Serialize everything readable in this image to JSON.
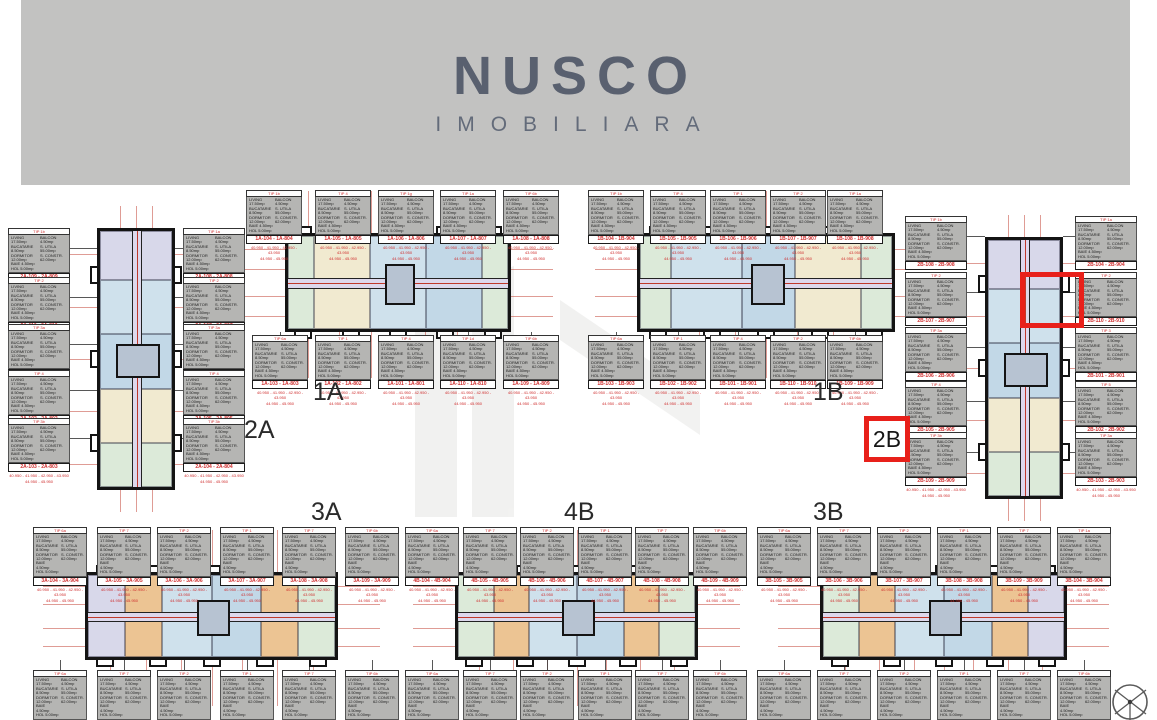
{
  "logo": {
    "title": "NUSCO",
    "subtitle": "IMOBILIARA"
  },
  "palette": {
    "banner": "#c2c2c1",
    "logo": "#59606f",
    "dim_red": "#c0392b",
    "card_red": "#cf2e2e",
    "highlight_red": "#e8201a",
    "plan_border": "#141414",
    "card_gray": "#b5b5b3",
    "corridor": "#ddd8ec",
    "watermark": "#ececec",
    "unit_green": "#dcead9",
    "unit_cream": "#f1ead0",
    "unit_blue": "#cfe1ec",
    "unit_blue2": "#c2d8e7",
    "unit_lavender": "#d8d8ea",
    "unit_orange": "#ecc493"
  },
  "card_shared": {
    "details_left": [
      "LIVING 17.50mp",
      "BUCATARIE 8.50mp",
      "DORMITOR 12.00mp",
      "BAIE 4.50mp",
      "HOL 5.00mp"
    ],
    "details_right": [
      "BALCON 4.50mp",
      "S. UTILA 55.00mp",
      "S. CONSTR. 62.00mp"
    ],
    "prices_line1": "40.950 - 41.950 - 42.950 - 43.950",
    "prices_line2": "44.950 - 45.950"
  },
  "buildings": [
    {
      "id": "2A",
      "title": "2A",
      "orientation": "vertical",
      "plan": {
        "x": 97,
        "y": 228,
        "w": 78,
        "h": 262
      },
      "title_pos": {
        "x": 244,
        "y": 416
      },
      "sections": [
        {
          "color": "#d8d8ea",
          "flex": 1
        },
        {
          "color": "#cfe1ec",
          "flex": 1.1
        },
        {
          "color": "#c2d8e7",
          "flex": 1.1
        },
        {
          "color": "#f1ead0",
          "flex": 1.1
        },
        {
          "color": "#dcead9",
          "flex": 0.9
        }
      ],
      "cards": {
        "left": {
          "x": 8,
          "w": 62,
          "tops": [
            228,
            277,
            324,
            370,
            418
          ],
          "items": [
            {
              "tip": "TIP 1b",
              "unit": "2A-109 - 2A-809"
            },
            {
              "tip": "TIP 2",
              "unit": "2A-110 - 2A-810"
            },
            {
              "tip": "TIP 3a",
              "unit": "2A-101 - 2A-801"
            },
            {
              "tip": "TIP 4",
              "unit": "2A-102 - 2A-802"
            },
            {
              "tip": "TIP 3b",
              "unit": "2A-103 - 2A-803"
            }
          ]
        },
        "right": {
          "x": 183,
          "w": 62,
          "tops": [
            228,
            277,
            324,
            370,
            418
          ],
          "items": [
            {
              "tip": "TIP 1a",
              "unit": "2A-108 - 2A-808"
            },
            {
              "tip": "TIP 2",
              "unit": "2A-107 - 2A-807"
            },
            {
              "tip": "TIP 3a",
              "unit": "2A-106 - 2A-806"
            },
            {
              "tip": "TIP 4",
              "unit": "2A-105 - 2A-805"
            },
            {
              "tip": "TIP 3b",
              "unit": "2A-104 - 2A-804"
            }
          ]
        }
      }
    },
    {
      "id": "1A",
      "title": "1A",
      "orientation": "horizontal",
      "plan": {
        "x": 285,
        "y": 233,
        "w": 226,
        "h": 99
      },
      "title_pos": {
        "x": 313,
        "y": 378
      },
      "sections": [
        {
          "color": "#dcead9",
          "flex": 0.7
        },
        {
          "color": "#f1ead0",
          "flex": 1.5
        },
        {
          "color": "#cfe1ec",
          "flex": 1.5
        },
        {
          "color": "#c2d8e7",
          "flex": 1.5
        },
        {
          "color": "#dcead9",
          "flex": 0.7
        }
      ],
      "cards": {
        "top": {
          "y": 190,
          "w": 56,
          "xs": [
            246,
            315,
            378,
            440,
            503
          ],
          "items": [
            {
              "tip": "TIP 1b",
              "unit": "1A-104 - 1A-804"
            },
            {
              "tip": "TIP 4",
              "unit": "1A-105 - 1A-805"
            },
            {
              "tip": "TIP 1g",
              "unit": "1A-106 - 1A-806"
            },
            {
              "tip": "TIP 1a",
              "unit": "1A-107 - 1A-807"
            },
            {
              "tip": "TIP 6b",
              "unit": "1A-108 - 1A-808"
            }
          ]
        },
        "bottom": {
          "y": 335,
          "w": 56,
          "xs": [
            252,
            315,
            378,
            440,
            503
          ],
          "items": [
            {
              "tip": "TIP 6a",
              "unit": "1A-103 - 1A-803"
            },
            {
              "tip": "TIP 1",
              "unit": "1A-102 - 1A-802"
            },
            {
              "tip": "TIP 4",
              "unit": "1A-101 - 1A-801"
            },
            {
              "tip": "TIP 1d",
              "unit": "1A-110 - 1A-810"
            },
            {
              "tip": "TIP 6b",
              "unit": "1A-109 - 1A-809"
            }
          ]
        }
      }
    },
    {
      "id": "1B",
      "title": "1B",
      "orientation": "horizontal",
      "plan": {
        "x": 637,
        "y": 233,
        "w": 258,
        "h": 99
      },
      "title_pos": {
        "x": 813,
        "y": 378
      },
      "sections": [
        {
          "color": "#dcead9",
          "flex": 0.7
        },
        {
          "color": "#cfe1ec",
          "flex": 1.6
        },
        {
          "color": "#c2d8e7",
          "flex": 1.2
        },
        {
          "color": "#f1ead0",
          "flex": 1.5
        },
        {
          "color": "#dcead9",
          "flex": 0.7
        }
      ],
      "cards": {
        "top": {
          "y": 190,
          "w": 56,
          "xs": [
            588,
            650,
            710,
            770,
            827
          ],
          "items": [
            {
              "tip": "TIP 1b",
              "unit": "1B-104 - 1B-904"
            },
            {
              "tip": "TIP 4",
              "unit": "1B-105 - 1B-905"
            },
            {
              "tip": "TIP 1",
              "unit": "1B-106 - 1B-906"
            },
            {
              "tip": "TIP 2",
              "unit": "1B-107 - 1B-907"
            },
            {
              "tip": "TIP 1a",
              "unit": "1B-108 - 1B-908"
            }
          ]
        },
        "bottom": {
          "y": 335,
          "w": 56,
          "xs": [
            588,
            650,
            710,
            770,
            827
          ],
          "items": [
            {
              "tip": "TIP 6a",
              "unit": "1B-103 - 1B-903"
            },
            {
              "tip": "TIP 1",
              "unit": "1B-102 - 1B-902"
            },
            {
              "tip": "TIP 4",
              "unit": "1B-101 - 1B-901"
            },
            {
              "tip": "TIP 2",
              "unit": "1B-110 - 1B-910"
            },
            {
              "tip": "TIP 6b",
              "unit": "1B-109 - 1B-909"
            }
          ]
        }
      }
    },
    {
      "id": "2B",
      "title": "2B",
      "orientation": "vertical",
      "plan": {
        "x": 985,
        "y": 237,
        "w": 78,
        "h": 262
      },
      "title_pos": null,
      "sections": [
        {
          "color": "#d8d8ea",
          "flex": 1
        },
        {
          "color": "#cfe1ec",
          "flex": 1.1
        },
        {
          "color": "#c2d8e7",
          "flex": 1.1
        },
        {
          "color": "#f1ead0",
          "flex": 1.1
        },
        {
          "color": "#dcead9",
          "flex": 0.9
        }
      ],
      "cards": {
        "left": {
          "x": 905,
          "w": 62,
          "tops": [
            216,
            272,
            327,
            381,
            432
          ],
          "items": [
            {
              "tip": "TIP 1b",
              "unit": "2B-108 - 2B-908"
            },
            {
              "tip": "TIP 2",
              "unit": "2B-107 - 2B-907"
            },
            {
              "tip": "TIP 3a",
              "unit": "2B-106 - 2B-906"
            },
            {
              "tip": "TIP 4",
              "unit": "2B-105 - 2B-905"
            },
            {
              "tip": "TIP 3b",
              "unit": "2B-109 - 2B-909"
            }
          ]
        },
        "right": {
          "x": 1075,
          "w": 62,
          "tops": [
            216,
            272,
            327,
            381,
            432
          ],
          "items": [
            {
              "tip": "TIP 1a",
              "unit": "2B-104 - 2B-904"
            },
            {
              "tip": "TIP 2",
              "unit": "2B-110 - 2B-910"
            },
            {
              "tip": "TIP 3",
              "unit": "2B-101 - 2B-901"
            },
            {
              "tip": "TIP 5",
              "unit": "2B-102 - 2B-902"
            },
            {
              "tip": "TIP 3a",
              "unit": "2B-103 - 2B-903"
            }
          ]
        }
      }
    },
    {
      "id": "3A",
      "title": "3A",
      "orientation": "horizontal",
      "plan": {
        "x": 85,
        "y": 572,
        "w": 253,
        "h": 88
      },
      "title_pos": {
        "x": 311,
        "y": 498
      },
      "sections": [
        {
          "color": "#d8d8ea",
          "flex": 0.9
        },
        {
          "color": "#ecc493",
          "flex": 0.9
        },
        {
          "color": "#cfe1ec",
          "flex": 1.2
        },
        {
          "color": "#c2d8e7",
          "flex": 1.2
        },
        {
          "color": "#ecc493",
          "flex": 0.9
        },
        {
          "color": "#dcead9",
          "flex": 0.9
        }
      ],
      "cards": {
        "top": {
          "y": 527,
          "w": 54,
          "xs": [
            33,
            97,
            157,
            220,
            282,
            345
          ],
          "items": [
            {
              "tip": "TIP 6a",
              "unit": "3A-104 - 3A-904"
            },
            {
              "tip": "TIP 7",
              "unit": "3A-105 - 3A-905"
            },
            {
              "tip": "TIP 2",
              "unit": "3A-106 - 3A-906"
            },
            {
              "tip": "TIP 1",
              "unit": "3A-107 - 3A-907"
            },
            {
              "tip": "TIP 7",
              "unit": "3A-108 - 3A-908"
            },
            {
              "tip": "TIP 6b",
              "unit": "3A-109 - 3A-909"
            }
          ]
        },
        "bottom": {
          "y": 670,
          "w": 54,
          "xs": [
            33,
            97,
            157,
            220,
            282,
            345
          ],
          "items": [
            {
              "tip": "TIP 6a",
              "unit": "3A-103 - 3A-903"
            },
            {
              "tip": "TIP 7",
              "unit": "3A-102 - 3A-902"
            },
            {
              "tip": "TIP 2",
              "unit": "3A-101 - 3A-901"
            },
            {
              "tip": "TIP 1",
              "unit": "3A-112 - 3A-912"
            },
            {
              "tip": "TIP 7",
              "unit": "3A-111 - 3A-911"
            },
            {
              "tip": "TIP 6b",
              "unit": "3A-110 - 3A-910"
            }
          ]
        }
      }
    },
    {
      "id": "4B",
      "title": "4B",
      "orientation": "horizontal",
      "plan": {
        "x": 455,
        "y": 572,
        "w": 243,
        "h": 88
      },
      "title_pos": {
        "x": 564,
        "y": 498
      },
      "sections": [
        {
          "color": "#dcead9",
          "flex": 0.9
        },
        {
          "color": "#ecc493",
          "flex": 0.9
        },
        {
          "color": "#cfe1ec",
          "flex": 1.2
        },
        {
          "color": "#c2d8e7",
          "flex": 1.2
        },
        {
          "color": "#ecc493",
          "flex": 0.9
        },
        {
          "color": "#dcead9",
          "flex": 0.9
        }
      ],
      "cards": {
        "top": {
          "y": 527,
          "w": 54,
          "xs": [
            405,
            463,
            520,
            578,
            635,
            693
          ],
          "items": [
            {
              "tip": "TIP 6a",
              "unit": "4B-104 - 4B-904"
            },
            {
              "tip": "TIP 7",
              "unit": "4B-105 - 4B-905"
            },
            {
              "tip": "TIP 2",
              "unit": "4B-106 - 4B-906"
            },
            {
              "tip": "TIP 1",
              "unit": "4B-107 - 4B-907"
            },
            {
              "tip": "TIP 7",
              "unit": "4B-108 - 4B-908"
            },
            {
              "tip": "TIP 6b",
              "unit": "4B-109 - 4B-909"
            }
          ]
        },
        "bottom": {
          "y": 670,
          "w": 54,
          "xs": [
            405,
            463,
            520,
            578,
            635,
            693
          ],
          "items": [
            {
              "tip": "TIP 6a",
              "unit": "4B-103 - 4B-903"
            },
            {
              "tip": "TIP 7",
              "unit": "4B-102 - 4B-902"
            },
            {
              "tip": "TIP 2",
              "unit": "4B-101 - 4B-901"
            },
            {
              "tip": "TIP 1",
              "unit": "4B-112 - 4B-912"
            },
            {
              "tip": "TIP 7",
              "unit": "4B-111 - 4B-911"
            },
            {
              "tip": "TIP 6b",
              "unit": "4B-110 - 4B-910"
            }
          ]
        }
      }
    },
    {
      "id": "3B",
      "title": "3B",
      "orientation": "horizontal",
      "plan": {
        "x": 820,
        "y": 572,
        "w": 247,
        "h": 88
      },
      "title_pos": {
        "x": 813,
        "y": 498
      },
      "sections": [
        {
          "color": "#dcead9",
          "flex": 0.9
        },
        {
          "color": "#ecc493",
          "flex": 0.9
        },
        {
          "color": "#cfe1ec",
          "flex": 1.2
        },
        {
          "color": "#c2d8e7",
          "flex": 1.2
        },
        {
          "color": "#ecc493",
          "flex": 0.9
        },
        {
          "color": "#d8d8ea",
          "flex": 0.9
        }
      ],
      "cards": {
        "top": {
          "y": 527,
          "w": 54,
          "xs": [
            757,
            817,
            877,
            937,
            997,
            1057
          ],
          "items": [
            {
              "tip": "TIP 6a",
              "unit": "3B-105 - 3B-905"
            },
            {
              "tip": "TIP 7",
              "unit": "3B-106 - 3B-906"
            },
            {
              "tip": "TIP 2",
              "unit": "3B-107 - 3B-907"
            },
            {
              "tip": "TIP 1",
              "unit": "3B-108 - 3B-908"
            },
            {
              "tip": "TIP 7",
              "unit": "3B-109 - 3B-909"
            },
            {
              "tip": "TIP 1a",
              "unit": "3B-104 - 3B-904"
            }
          ]
        },
        "bottom": {
          "y": 670,
          "w": 54,
          "xs": [
            757,
            817,
            877,
            937,
            997,
            1057
          ],
          "items": [
            {
              "tip": "TIP 6a",
              "unit": "3B-110 - 3B-910"
            },
            {
              "tip": "TIP 7",
              "unit": "3B-111 - 3B-911"
            },
            {
              "tip": "TIP 2",
              "unit": "3B-112 - 3B-912"
            },
            {
              "tip": "TIP 1",
              "unit": "3B-101 - 3B-901"
            },
            {
              "tip": "TIP 7",
              "unit": "3B-102 - 3B-902"
            },
            {
              "tip": "TIP 6b",
              "unit": "3B-103 - 3B-903"
            }
          ]
        }
      }
    }
  ],
  "highlight": {
    "rect": {
      "x": 1020,
      "y": 272,
      "w": 64,
      "h": 56
    },
    "label_box": {
      "x": 864,
      "y": 416,
      "w": 46,
      "h": 46,
      "text": "2B"
    }
  }
}
